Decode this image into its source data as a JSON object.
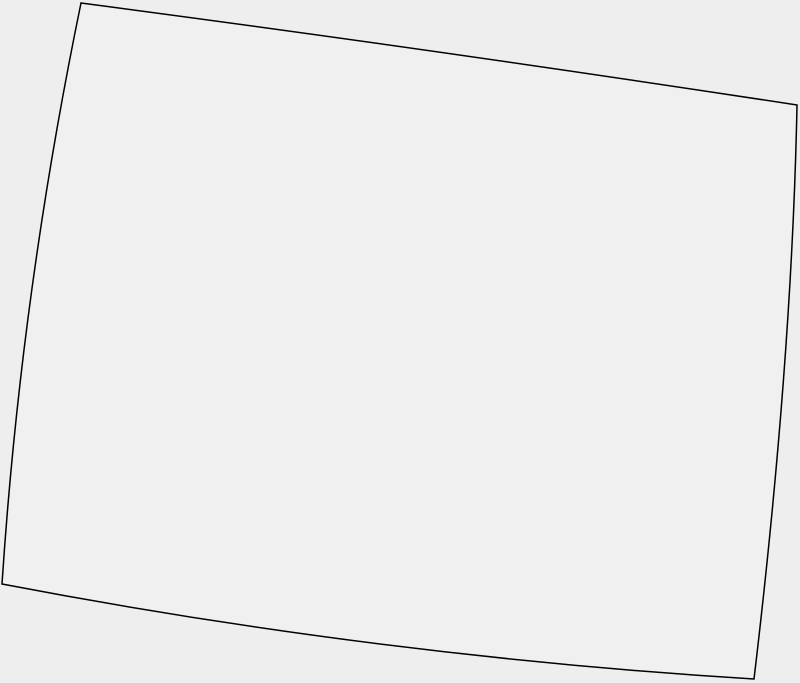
{
  "canvas": {
    "width": 800,
    "height": 683
  },
  "theme": {
    "canvas_background": "#eeeeee",
    "region_fill": "#f0f0f0",
    "outline_stroke": "#000000",
    "outline_stroke_width": "1.5"
  },
  "map": {
    "outline": {
      "path": "M 81 3 Q 438 50 797 105 Q 792 360 754 679 Q 378 656 2 584 Q 21 294 81 3 Z",
      "corners": {
        "top_left": [
          81,
          3
        ],
        "top_right": [
          797,
          105
        ],
        "bottom_right": [
          754,
          679
        ],
        "bottom_left": [
          2,
          584
        ]
      }
    }
  }
}
